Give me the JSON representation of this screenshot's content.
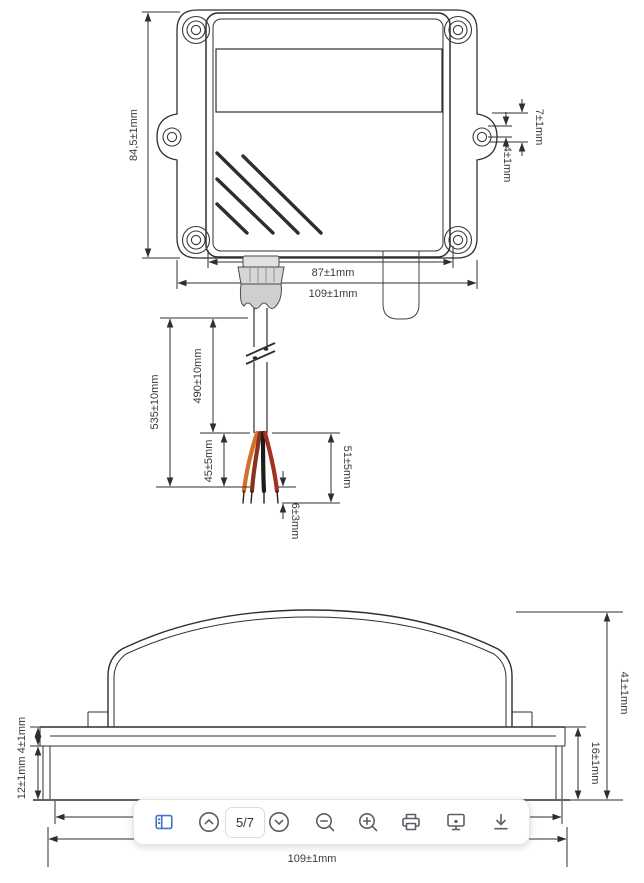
{
  "toolbar": {
    "page_indicator": "5/7",
    "icons": [
      "thumbnails-panel",
      "previous-page",
      "next-page",
      "zoom-out",
      "zoom-in",
      "print",
      "presentation-mode",
      "download"
    ]
  },
  "front_view": {
    "height_label": "84,5±1mm",
    "ear_offset_label": "7±1mm",
    "ear_hole_label": "4±1mm",
    "body_width_label": "87±1mm",
    "overall_width_label": "109±1mm",
    "cable": {
      "overall_label": "535±10mm",
      "sheath_label": "490±10mm",
      "split_label": "45±5mm",
      "stripped_label": "51±5mm",
      "tip_label": "6±3mm"
    }
  },
  "side_view": {
    "overall_height_label": "41±1mm",
    "base_height_label": "16±1mm",
    "flange_labels": "12±1mm 4±1mm",
    "width_label": "109±1mm"
  },
  "colors": {
    "accent_blue": "#4577c9",
    "icon_gray": "#5a5f64",
    "line_dark": "#2f2f2f",
    "wire_orange": "#d4702a",
    "wire_maroon": "#8a3220",
    "wire_black": "#1c1c1c",
    "wire_red": "#a33020"
  }
}
